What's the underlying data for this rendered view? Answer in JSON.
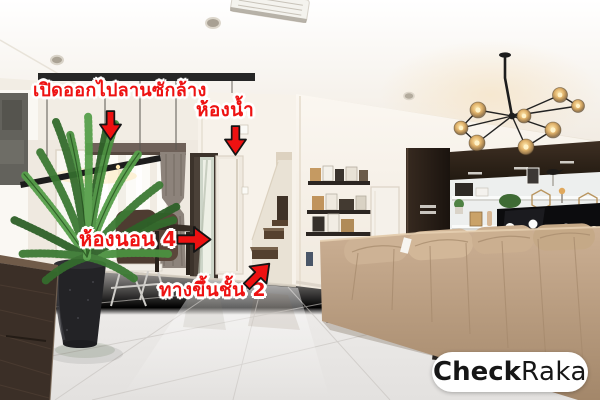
{
  "annotations": {
    "laundry": {
      "label": "เปิดออกไปลานซักล้าง",
      "icon": "arrow-down-icon"
    },
    "bathroom": {
      "label": "ห้องน้ำ",
      "icon": "arrow-down-icon"
    },
    "bedroom4": {
      "label": "ห้องนอน 4",
      "icon": "arrow-right-icon"
    },
    "stairs": {
      "label": "ทางขึ้นชั้น 2",
      "icon": "arrow-up-right-icon"
    }
  },
  "watermark": {
    "brand_bold": "Check",
    "brand_regular": "Raka"
  },
  "colors": {
    "annotation_red": "#ee1212",
    "annotation_outline": "#ffffff",
    "arrow_red": "#ee1111",
    "arrow_outline": "#151515",
    "watermark_bg": "#ffffff",
    "watermark_text": "#161616"
  }
}
